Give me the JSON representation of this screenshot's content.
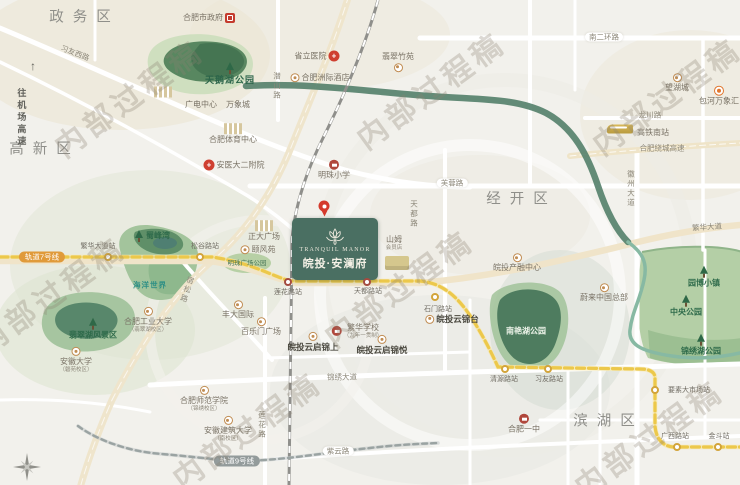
{
  "canvas": {
    "width": 740,
    "height": 485
  },
  "property": {
    "name_en": "TRANQUIL MANOR",
    "name_cn": "皖投·安澜府",
    "box_color": "#4a6f62"
  },
  "colors": {
    "metro7": "#ecc84b",
    "metro9": "#9aa3a2",
    "green_corridor": "#53806a",
    "park": "#b4cfa6",
    "road_major": "#efe4c8",
    "watermark": "rgba(140,128,112,0.30)",
    "line7_badge": "#e09a3a",
    "line9_badge": "#939b9b"
  },
  "items": [
    {
      "n": "watermark-1",
      "t": "内部过程稿",
      "x": 130,
      "y": 100,
      "c": "wm",
      "r": -36
    },
    {
      "n": "watermark-2",
      "t": "内部过程稿",
      "x": 432,
      "y": 92,
      "c": "wm",
      "r": -36
    },
    {
      "n": "watermark-3",
      "t": "内部过程稿",
      "x": 668,
      "y": 98,
      "c": "wm",
      "r": -36
    },
    {
      "n": "watermark-4",
      "t": "内部过程稿",
      "x": 52,
      "y": 297,
      "c": "wm",
      "r": -36
    },
    {
      "n": "watermark-5",
      "t": "内部过程稿",
      "x": 400,
      "y": 290,
      "c": "wm",
      "r": -36
    },
    {
      "n": "watermark-6",
      "t": "内部过程稿",
      "x": 248,
      "y": 432,
      "c": "wm",
      "r": -36
    },
    {
      "n": "watermark-7",
      "t": "内部过程稿",
      "x": 650,
      "y": 440,
      "c": "wm",
      "r": -36
    },
    {
      "n": "district-zhengwu",
      "t": "政务区",
      "x": 80,
      "y": 18,
      "c": "district"
    },
    {
      "n": "district-gaoxin",
      "t": "高新区",
      "x": 40,
      "y": 150,
      "c": "district"
    },
    {
      "n": "district-jingkai",
      "t": "经开区",
      "x": 517,
      "y": 200,
      "c": "district"
    },
    {
      "n": "district-binhu",
      "t": "滨湖区",
      "x": 604,
      "y": 422,
      "c": "district"
    },
    {
      "n": "road-xiyou-west",
      "t": "习友西路",
      "x": 75,
      "y": 53,
      "c": "road",
      "r": 21
    },
    {
      "n": "road-qianshan",
      "t": "潜山路",
      "x": 277,
      "y": 86,
      "c": "road",
      "v": true
    },
    {
      "n": "road-nanerhuan",
      "t": "南二环路",
      "x": 604,
      "y": 37,
      "c": "road pill"
    },
    {
      "n": "road-furong",
      "t": "芙蓉路",
      "x": 452,
      "y": 183,
      "c": "road pill"
    },
    {
      "n": "road-tiandu",
      "t": "天都路",
      "x": 414,
      "y": 214,
      "c": "road",
      "v": true
    },
    {
      "n": "road-longchuan",
      "t": "龙川路",
      "x": 650,
      "y": 115,
      "c": "road"
    },
    {
      "n": "road-raocheng-expressway",
      "t": "合肥绕城高速",
      "x": 662,
      "y": 148,
      "c": "road"
    },
    {
      "n": "road-huizhou-ave",
      "t": "徽州大道",
      "x": 631,
      "y": 189,
      "c": "road",
      "v": true
    },
    {
      "n": "road-fanhua-ave",
      "t": "繁华大道",
      "x": 707,
      "y": 227,
      "c": "road",
      "r": -4
    },
    {
      "n": "road-susong",
      "t": "宿松路",
      "x": 187,
      "y": 290,
      "c": "road",
      "v": true,
      "r": 18
    },
    {
      "n": "road-jinxiu-ave",
      "t": "锦绣大道",
      "x": 342,
      "y": 377,
      "c": "road"
    },
    {
      "n": "road-lianhua",
      "t": "莲花路",
      "x": 262,
      "y": 425,
      "c": "road",
      "v": true
    },
    {
      "n": "road-ziyun",
      "t": "紫云路",
      "x": 338,
      "y": 451,
      "c": "road pill"
    },
    {
      "n": "toward-airport-expressway",
      "t": "往机场高速",
      "x": 21,
      "y": 118,
      "c": "airport",
      "v": true
    },
    {
      "n": "toward-airport-arrow",
      "t": "↑",
      "x": 33,
      "y": 66,
      "c": "arrow"
    },
    {
      "n": "hefei-south-railway-station",
      "t": "高铁南站",
      "x": 653,
      "y": 133,
      "c": "poi"
    },
    {
      "n": "train",
      "x": 620,
      "y": 129,
      "c": "ictrain"
    },
    {
      "n": "line7-badge",
      "t": "轨道7号线",
      "x": 42,
      "y": 257,
      "c": "badge b7"
    },
    {
      "n": "line9-badge",
      "t": "轨道9号线",
      "x": 237,
      "y": 461,
      "c": "badge b9"
    },
    {
      "n": "station-dot-fanhua-dadao",
      "x": 108,
      "y": 257,
      "c": "dot gold"
    },
    {
      "n": "station-dot-songgu",
      "x": 200,
      "y": 257,
      "c": "dot gold"
    },
    {
      "n": "station-dot-lianhua",
      "x": 288,
      "y": 282,
      "c": "dot red"
    },
    {
      "n": "station-dot-tiandu",
      "x": 367,
      "y": 282,
      "c": "dot red"
    },
    {
      "n": "station-dot-shimen",
      "x": 435,
      "y": 297,
      "c": "dot gold"
    },
    {
      "n": "station-dot-qingyuan",
      "x": 505,
      "y": 369,
      "c": "dot gold"
    },
    {
      "n": "station-dot-xiyou",
      "x": 548,
      "y": 369,
      "c": "dot gold"
    },
    {
      "n": "station-dot-yaosu",
      "x": 655,
      "y": 390,
      "c": "dot gold"
    },
    {
      "n": "station-dot-guangxi",
      "x": 677,
      "y": 447,
      "c": "dot gold"
    },
    {
      "n": "station-dot-jindou",
      "x": 718,
      "y": 447,
      "c": "dot gold"
    },
    {
      "n": "station-fanhua-dadao",
      "t": "繁华大道站",
      "x": 98,
      "y": 247,
      "c": "station"
    },
    {
      "n": "station-songgu",
      "t": "松谷路站",
      "x": 205,
      "y": 247,
      "c": "station"
    },
    {
      "n": "station-lianhua",
      "t": "莲花路站",
      "x": 288,
      "y": 293,
      "c": "station"
    },
    {
      "n": "station-tiandu",
      "t": "天都路站",
      "x": 368,
      "y": 292,
      "c": "station"
    },
    {
      "n": "station-shimen",
      "t": "石门路站",
      "x": 438,
      "y": 310,
      "c": "station"
    },
    {
      "n": "station-qingyuan",
      "t": "清源路站",
      "x": 504,
      "y": 380,
      "c": "station"
    },
    {
      "n": "station-xiyou",
      "t": "习友路站",
      "x": 549,
      "y": 380,
      "c": "station"
    },
    {
      "n": "station-yaosu-market",
      "t": "要素大市场站",
      "x": 689,
      "y": 391,
      "c": "station"
    },
    {
      "n": "station-guangxi",
      "t": "广西路站",
      "x": 675,
      "y": 437,
      "c": "station"
    },
    {
      "n": "station-jindou",
      "t": "金斗站",
      "x": 719,
      "y": 437,
      "c": "station"
    },
    {
      "n": "poi-hefei-government",
      "t": "合肥市政府",
      "x": 209,
      "y": 18,
      "c": "poi",
      "i": "gov",
      "ip": "r"
    },
    {
      "n": "poi-provincial-hospital",
      "t": "省立医院",
      "x": 317,
      "y": 56,
      "c": "poi",
      "i": "cross",
      "ip": "r"
    },
    {
      "n": "poi-intercontinental-hotel",
      "t": "合肥洲际酒店",
      "x": 320,
      "y": 78,
      "c": "poi",
      "i": "tan",
      "ip": "l"
    },
    {
      "n": "poi-feicui-zhuyuan",
      "t": "翡翠竹苑",
      "x": 398,
      "y": 62,
      "c": "poi",
      "i": "tan",
      "ip": "b"
    },
    {
      "n": "poi-wanghucheng",
      "t": "望湖城",
      "x": 677,
      "y": 83,
      "c": "poi",
      "i": "tan",
      "ip": "t"
    },
    {
      "n": "poi-baohe-mixc",
      "t": "包河万象汇",
      "x": 719,
      "y": 96,
      "c": "poi",
      "i": "orange",
      "ip": "t"
    },
    {
      "n": "poi-guangdian-center",
      "t": "广电中心",
      "x": 201,
      "y": 105,
      "c": "poi"
    },
    {
      "n": "poi-mixc",
      "t": "万象城",
      "x": 238,
      "y": 105,
      "c": "poi"
    },
    {
      "n": "buildings",
      "x": 163,
      "y": 92,
      "c": "icbuildwrap",
      "i": "build"
    },
    {
      "n": "poi-hefei-sports-center",
      "t": "合肥体育中心",
      "x": 233,
      "y": 134,
      "c": "poi",
      "i": "build",
      "ip": "t"
    },
    {
      "n": "poi-anyida-2nd-hospital",
      "t": "安医大二附院",
      "x": 234,
      "y": 165,
      "c": "poi",
      "i": "cross",
      "ip": "l"
    },
    {
      "n": "poi-mingzhu-primary-school",
      "t": "明珠小学",
      "x": 334,
      "y": 170,
      "c": "poi",
      "i": "school",
      "ip": "t"
    },
    {
      "n": "poi-zhengda-plaza",
      "t": "正大广场",
      "x": 264,
      "y": 231,
      "c": "poi",
      "i": "build",
      "ip": "t"
    },
    {
      "n": "poi-yifengyuan",
      "t": "颐风苑",
      "x": 258,
      "y": 250,
      "c": "poi",
      "i": "tan",
      "ip": "l"
    },
    {
      "n": "poi-mingzhu-plaza-park",
      "t": "明珠广场公园",
      "x": 247,
      "y": 264,
      "c": "park small"
    },
    {
      "n": "poi-shufengwan",
      "t": "蜀峰湾",
      "x": 152,
      "y": 236,
      "c": "park",
      "i": "tree",
      "ip": "l"
    },
    {
      "n": "poi-ocean-world",
      "t": "海洋世界",
      "x": 150,
      "y": 285,
      "c": "teal"
    },
    {
      "n": "poi-swan-lake-park",
      "t": "天鹅湖公园",
      "x": 230,
      "y": 74,
      "c": "park big",
      "i": "tree",
      "ip": "t"
    },
    {
      "n": "poi-feicui-lake-scenic",
      "t": "翡翠湖风景区",
      "x": 93,
      "y": 329,
      "c": "park",
      "i": "tree",
      "ip": "t"
    },
    {
      "n": "poi-anhui-university",
      "t": "安徽大学",
      "s": "（磬苑校区）",
      "x": 76,
      "y": 360,
      "c": "poi",
      "i": "tan",
      "ip": "t"
    },
    {
      "n": "poi-hfut",
      "t": "合肥工业大学",
      "s": "（翡翠湖校区）",
      "x": 148,
      "y": 320,
      "c": "poi",
      "i": "tan",
      "ip": "t"
    },
    {
      "n": "poi-fengda-international",
      "t": "丰大国际",
      "x": 238,
      "y": 310,
      "c": "poi",
      "i": "tan",
      "ip": "t"
    },
    {
      "n": "poi-bailemen-plaza",
      "t": "百乐门广场",
      "x": 261,
      "y": 327,
      "c": "poi",
      "i": "tan",
      "ip": "t"
    },
    {
      "n": "poi-hefei-normal-university",
      "t": "合肥师范学院",
      "s": "（锦绣校区）",
      "x": 204,
      "y": 399,
      "c": "poi",
      "i": "tan",
      "ip": "t"
    },
    {
      "n": "poi-anhui-jianzhu-university",
      "t": "安徽建筑大学",
      "s": "（南校区）",
      "x": 228,
      "y": 429,
      "c": "poi",
      "i": "tan",
      "ip": "t"
    },
    {
      "n": "poi-yunqi-jinshang",
      "t": "皖投云启锦上",
      "x": 313,
      "y": 342,
      "c": "strong",
      "i": "tan",
      "ip": "t"
    },
    {
      "n": "poi-fanhua-school",
      "t": "繁华学校",
      "s": "（九年一贯制）",
      "x": 357,
      "y": 331,
      "c": "poi",
      "i": "school",
      "ip": "l"
    },
    {
      "n": "poi-yunqi-jinyue",
      "t": "皖投云启锦悦",
      "x": 382,
      "y": 345,
      "c": "strong",
      "i": "tan",
      "ip": "t"
    },
    {
      "n": "poi-yunjintai",
      "t": "皖投云锦台",
      "x": 452,
      "y": 319,
      "c": "strong",
      "i": "tan",
      "ip": "l"
    },
    {
      "n": "poi-sam-club",
      "t": "山姆",
      "s": "会员店",
      "x": 394,
      "y": 243,
      "c": "poi"
    },
    {
      "n": "sam-store",
      "x": 397,
      "y": 263,
      "c": "icstore"
    },
    {
      "n": "poi-wantou-chanrong-center",
      "t": "皖投产融中心",
      "x": 517,
      "y": 263,
      "c": "poi",
      "i": "tan",
      "ip": "t"
    },
    {
      "n": "poi-nio-china-hq",
      "t": "蔚来中国总部",
      "x": 604,
      "y": 293,
      "c": "poi",
      "i": "tan",
      "ip": "t"
    },
    {
      "n": "poi-yuanbo-town",
      "t": "园博小镇",
      "x": 704,
      "y": 277,
      "c": "park",
      "i": "tree",
      "ip": "t"
    },
    {
      "n": "poi-central-park",
      "t": "中央公园",
      "x": 686,
      "y": 306,
      "c": "park",
      "i": "tree",
      "ip": "t"
    },
    {
      "n": "poi-jinxiu-lake-park",
      "t": "锦绣湖公园",
      "x": 701,
      "y": 345,
      "c": "park",
      "i": "tree",
      "ip": "t"
    },
    {
      "n": "poi-nanyan-lake-park",
      "t": "南艳湖公园",
      "x": 526,
      "y": 331,
      "c": "parkwhite",
      "i": "treelight",
      "ip": "t"
    },
    {
      "n": "poi-hefei-no1-school",
      "t": "合肥一中",
      "x": 524,
      "y": 424,
      "c": "poi",
      "i": "school",
      "ip": "t"
    },
    {
      "n": "location-pin",
      "x": 324,
      "y": 206,
      "c": "icpin"
    }
  ]
}
